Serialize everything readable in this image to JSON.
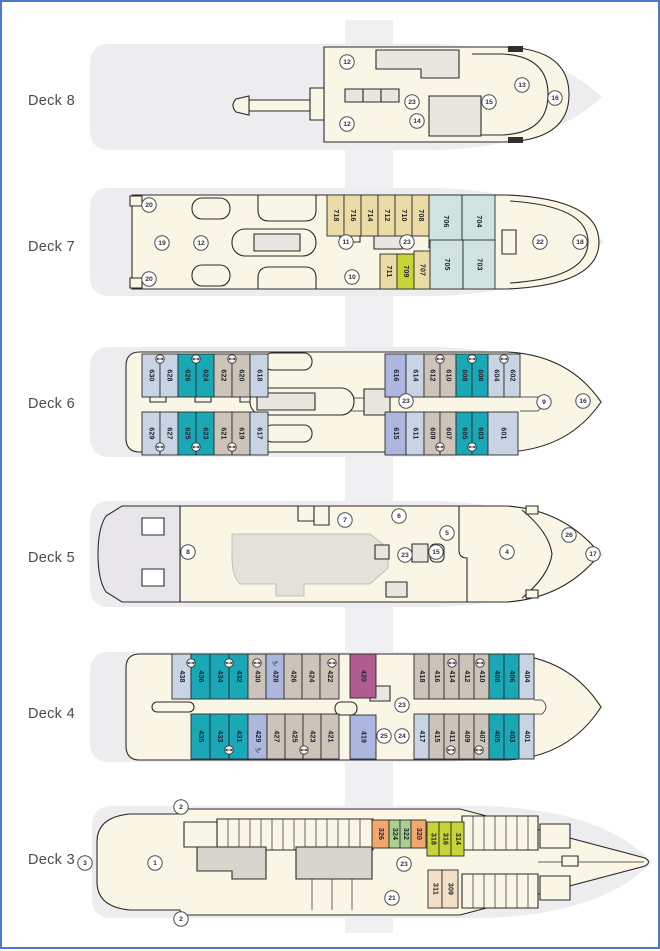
{
  "page": {
    "border_color": "#4e79cb",
    "background": "#ffffff"
  },
  "palette": {
    "cream": "#FAF6E6",
    "silhouette": "#EDEDF0",
    "room": "#E9E6E0",
    "gray3": "#D8D5CF",
    "white": "#FFFFFF",
    "lightblue": "#C8D4E3",
    "teal": "#1BA8B6",
    "graytan": "#CCC4B8",
    "periwinkle": "#ADB6DF",
    "tan": "#EBDCA6",
    "cyanpale": "#CFE3E0",
    "chartreuse": "#C6D435",
    "green": "#A9D08E",
    "orange": "#F2A76B",
    "peach": "#F3DFC5",
    "magenta": "#B05C90",
    "sterngray": "#E8E6EA",
    "outline": "#2B2B2B"
  },
  "glyphs": {
    "anchor": "⚓"
  },
  "decks": [
    {
      "id": "deck8",
      "label": "Deck 8",
      "cabins": [],
      "icons": [],
      "circles": [
        {
          "n": "12",
          "x": 345,
          "y": 60
        },
        {
          "n": "12",
          "x": 345,
          "y": 122
        },
        {
          "n": "23",
          "x": 410,
          "y": 100
        },
        {
          "n": "14",
          "x": 415,
          "y": 119
        },
        {
          "n": "15",
          "x": 487,
          "y": 100
        },
        {
          "n": "13",
          "x": 520,
          "y": 83
        },
        {
          "n": "16",
          "x": 553,
          "y": 96
        }
      ]
    },
    {
      "id": "deck7",
      "label": "Deck 7",
      "cabins": [
        {
          "num": "718",
          "x": 325,
          "y": 193,
          "w": 17,
          "h": 41,
          "color": "tan"
        },
        {
          "num": "716",
          "x": 342,
          "y": 193,
          "w": 17,
          "h": 41,
          "color": "tan"
        },
        {
          "num": "714",
          "x": 359,
          "y": 193,
          "w": 17,
          "h": 41,
          "color": "tan"
        },
        {
          "num": "712",
          "x": 376,
          "y": 193,
          "w": 17,
          "h": 41,
          "color": "tan"
        },
        {
          "num": "710",
          "x": 393,
          "y": 193,
          "w": 17,
          "h": 41,
          "color": "tan"
        },
        {
          "num": "708",
          "x": 410,
          "y": 193,
          "w": 17,
          "h": 41,
          "color": "tan"
        },
        {
          "num": "706",
          "x": 427,
          "y": 193,
          "w": 33,
          "h": 53,
          "color": "cyanpale"
        },
        {
          "num": "704",
          "x": 460,
          "y": 193,
          "w": 33,
          "h": 53,
          "color": "cyanpale"
        },
        {
          "num": "711",
          "x": 378,
          "y": 252,
          "w": 17,
          "h": 35,
          "color": "tan"
        },
        {
          "num": "709",
          "x": 395,
          "y": 252,
          "w": 17,
          "h": 35,
          "color": "chartreuse"
        },
        {
          "num": "707",
          "x": 412,
          "y": 249,
          "w": 16,
          "h": 38,
          "color": "tan"
        },
        {
          "num": "705",
          "x": 428,
          "y": 238,
          "w": 33,
          "h": 49,
          "color": "cyanpale"
        },
        {
          "num": "703",
          "x": 461,
          "y": 238,
          "w": 32,
          "h": 49,
          "color": "cyanpale"
        }
      ],
      "icons": [],
      "circles": [
        {
          "n": "20",
          "x": 147,
          "y": 203
        },
        {
          "n": "19",
          "x": 160,
          "y": 241
        },
        {
          "n": "12",
          "x": 199,
          "y": 241
        },
        {
          "n": "11",
          "x": 344,
          "y": 240
        },
        {
          "n": "23",
          "x": 405,
          "y": 240
        },
        {
          "n": "10",
          "x": 350,
          "y": 275
        },
        {
          "n": "22",
          "x": 538,
          "y": 240
        },
        {
          "n": "18",
          "x": 578,
          "y": 240
        },
        {
          "n": "20",
          "x": 147,
          "y": 277
        }
      ]
    },
    {
      "id": "deck6",
      "label": "Deck 6",
      "cabins": [
        {
          "num": "630",
          "x": 140,
          "y": 352,
          "w": 18,
          "h": 43,
          "color": "lightblue"
        },
        {
          "num": "628",
          "x": 158,
          "y": 352,
          "w": 18,
          "h": 43,
          "color": "lightblue"
        },
        {
          "num": "626",
          "x": 176,
          "y": 352,
          "w": 18,
          "h": 43,
          "color": "teal"
        },
        {
          "num": "624",
          "x": 194,
          "y": 352,
          "w": 18,
          "h": 43,
          "color": "teal"
        },
        {
          "num": "622",
          "x": 212,
          "y": 352,
          "w": 18,
          "h": 43,
          "color": "graytan"
        },
        {
          "num": "620",
          "x": 230,
          "y": 352,
          "w": 18,
          "h": 43,
          "color": "graytan"
        },
        {
          "num": "618",
          "x": 248,
          "y": 352,
          "w": 18,
          "h": 43,
          "color": "lightblue"
        },
        {
          "num": "616",
          "x": 383,
          "y": 352,
          "w": 21,
          "h": 43,
          "color": "periwinkle"
        },
        {
          "num": "614",
          "x": 404,
          "y": 352,
          "w": 18,
          "h": 43,
          "color": "lightblue"
        },
        {
          "num": "612",
          "x": 422,
          "y": 352,
          "w": 16,
          "h": 43,
          "color": "graytan"
        },
        {
          "num": "610",
          "x": 438,
          "y": 352,
          "w": 16,
          "h": 43,
          "color": "graytan"
        },
        {
          "num": "608",
          "x": 454,
          "y": 352,
          "w": 16,
          "h": 43,
          "color": "teal"
        },
        {
          "num": "606",
          "x": 470,
          "y": 352,
          "w": 16,
          "h": 43,
          "color": "teal"
        },
        {
          "num": "604",
          "x": 486,
          "y": 352,
          "w": 16,
          "h": 43,
          "color": "lightblue"
        },
        {
          "num": "602",
          "x": 502,
          "y": 352,
          "w": 16,
          "h": 43,
          "color": "lightblue"
        },
        {
          "num": "629",
          "x": 140,
          "y": 410,
          "w": 18,
          "h": 43,
          "color": "lightblue"
        },
        {
          "num": "627",
          "x": 158,
          "y": 410,
          "w": 18,
          "h": 43,
          "color": "lightblue"
        },
        {
          "num": "625",
          "x": 176,
          "y": 410,
          "w": 18,
          "h": 43,
          "color": "teal"
        },
        {
          "num": "623",
          "x": 194,
          "y": 410,
          "w": 18,
          "h": 43,
          "color": "teal"
        },
        {
          "num": "621",
          "x": 212,
          "y": 410,
          "w": 18,
          "h": 43,
          "color": "graytan"
        },
        {
          "num": "619",
          "x": 230,
          "y": 410,
          "w": 18,
          "h": 43,
          "color": "graytan"
        },
        {
          "num": "617",
          "x": 248,
          "y": 410,
          "w": 18,
          "h": 43,
          "color": "lightblue"
        },
        {
          "num": "615",
          "x": 383,
          "y": 410,
          "w": 21,
          "h": 43,
          "color": "periwinkle"
        },
        {
          "num": "611",
          "x": 404,
          "y": 410,
          "w": 18,
          "h": 43,
          "color": "lightblue"
        },
        {
          "num": "609",
          "x": 422,
          "y": 410,
          "w": 16,
          "h": 43,
          "color": "graytan"
        },
        {
          "num": "607",
          "x": 438,
          "y": 410,
          "w": 16,
          "h": 43,
          "color": "graytan"
        },
        {
          "num": "605",
          "x": 454,
          "y": 410,
          "w": 16,
          "h": 43,
          "color": "teal"
        },
        {
          "num": "603",
          "x": 470,
          "y": 410,
          "w": 16,
          "h": 43,
          "color": "teal"
        },
        {
          "num": "601",
          "x": 486,
          "y": 410,
          "w": 30,
          "h": 43,
          "color": "lightblue"
        }
      ],
      "icons": [
        {
          "t": "conn",
          "x": 158,
          "y": 357
        },
        {
          "t": "conn",
          "x": 194,
          "y": 357
        },
        {
          "t": "conn",
          "x": 230,
          "y": 357
        },
        {
          "t": "conn",
          "x": 438,
          "y": 357
        },
        {
          "t": "conn",
          "x": 470,
          "y": 357
        },
        {
          "t": "conn",
          "x": 502,
          "y": 357
        },
        {
          "t": "conn",
          "x": 158,
          "y": 445
        },
        {
          "t": "conn",
          "x": 194,
          "y": 445
        },
        {
          "t": "conn",
          "x": 230,
          "y": 445
        },
        {
          "t": "conn",
          "x": 438,
          "y": 445
        },
        {
          "t": "conn",
          "x": 470,
          "y": 445
        }
      ],
      "circles": [
        {
          "n": "23",
          "x": 404,
          "y": 399
        },
        {
          "n": "9",
          "x": 542,
          "y": 400
        },
        {
          "n": "16",
          "x": 581,
          "y": 399
        }
      ]
    },
    {
      "id": "deck5",
      "label": "Deck 5",
      "cabins": [],
      "icons": [],
      "circles": [
        {
          "n": "8",
          "x": 186,
          "y": 550
        },
        {
          "n": "7",
          "x": 343,
          "y": 518
        },
        {
          "n": "6",
          "x": 397,
          "y": 514
        },
        {
          "n": "5",
          "x": 445,
          "y": 531
        },
        {
          "n": "23",
          "x": 403,
          "y": 553
        },
        {
          "n": "15",
          "x": 434,
          "y": 550
        },
        {
          "n": "4",
          "x": 505,
          "y": 550
        },
        {
          "n": "26",
          "x": 567,
          "y": 533
        },
        {
          "n": "17",
          "x": 591,
          "y": 552
        }
      ]
    },
    {
      "id": "deck4",
      "label": "Deck 4",
      "cabins": [
        {
          "num": "438",
          "x": 170,
          "y": 652,
          "w": 19,
          "h": 45,
          "color": "lightblue"
        },
        {
          "num": "436",
          "x": 189,
          "y": 652,
          "w": 19,
          "h": 45,
          "color": "teal"
        },
        {
          "num": "434",
          "x": 208,
          "y": 652,
          "w": 19,
          "h": 45,
          "color": "teal"
        },
        {
          "num": "432",
          "x": 227,
          "y": 652,
          "w": 19,
          "h": 45,
          "color": "teal"
        },
        {
          "num": "430",
          "x": 246,
          "y": 652,
          "w": 18,
          "h": 45,
          "color": "graytan"
        },
        {
          "num": "428",
          "x": 264,
          "y": 652,
          "w": 18,
          "h": 45,
          "color": "periwinkle"
        },
        {
          "num": "426",
          "x": 282,
          "y": 652,
          "w": 18,
          "h": 45,
          "color": "graytan"
        },
        {
          "num": "424",
          "x": 300,
          "y": 652,
          "w": 18,
          "h": 45,
          "color": "graytan"
        },
        {
          "num": "422",
          "x": 318,
          "y": 652,
          "w": 19,
          "h": 45,
          "color": "graytan"
        },
        {
          "num": "420",
          "x": 348,
          "y": 652,
          "w": 26,
          "h": 44,
          "color": "magenta"
        },
        {
          "num": "418",
          "x": 412,
          "y": 652,
          "w": 15,
          "h": 45,
          "color": "graytan"
        },
        {
          "num": "416",
          "x": 427,
          "y": 652,
          "w": 15,
          "h": 45,
          "color": "graytan"
        },
        {
          "num": "414",
          "x": 442,
          "y": 652,
          "w": 15,
          "h": 45,
          "color": "graytan"
        },
        {
          "num": "412",
          "x": 457,
          "y": 652,
          "w": 15,
          "h": 45,
          "color": "graytan"
        },
        {
          "num": "410",
          "x": 472,
          "y": 652,
          "w": 15,
          "h": 45,
          "color": "graytan"
        },
        {
          "num": "408",
          "x": 487,
          "y": 652,
          "w": 15,
          "h": 45,
          "color": "teal"
        },
        {
          "num": "406",
          "x": 502,
          "y": 652,
          "w": 15,
          "h": 45,
          "color": "teal"
        },
        {
          "num": "404",
          "x": 517,
          "y": 652,
          "w": 15,
          "h": 45,
          "color": "lightblue"
        },
        {
          "num": "435",
          "x": 189,
          "y": 712,
          "w": 19,
          "h": 45,
          "color": "teal"
        },
        {
          "num": "433",
          "x": 208,
          "y": 712,
          "w": 19,
          "h": 45,
          "color": "teal"
        },
        {
          "num": "431",
          "x": 227,
          "y": 712,
          "w": 19,
          "h": 45,
          "color": "teal"
        },
        {
          "num": "429",
          "x": 246,
          "y": 712,
          "w": 19,
          "h": 45,
          "color": "periwinkle"
        },
        {
          "num": "427",
          "x": 265,
          "y": 712,
          "w": 18,
          "h": 45,
          "color": "graytan"
        },
        {
          "num": "425",
          "x": 283,
          "y": 712,
          "w": 18,
          "h": 45,
          "color": "graytan"
        },
        {
          "num": "423",
          "x": 301,
          "y": 712,
          "w": 18,
          "h": 45,
          "color": "graytan"
        },
        {
          "num": "421",
          "x": 319,
          "y": 712,
          "w": 18,
          "h": 45,
          "color": "graytan"
        },
        {
          "num": "419",
          "x": 348,
          "y": 713,
          "w": 26,
          "h": 44,
          "color": "periwinkle"
        },
        {
          "num": "417",
          "x": 412,
          "y": 712,
          "w": 15,
          "h": 45,
          "color": "lightblue"
        },
        {
          "num": "415",
          "x": 427,
          "y": 712,
          "w": 15,
          "h": 45,
          "color": "graytan"
        },
        {
          "num": "411",
          "x": 442,
          "y": 712,
          "w": 15,
          "h": 45,
          "color": "graytan"
        },
        {
          "num": "409",
          "x": 457,
          "y": 712,
          "w": 15,
          "h": 45,
          "color": "graytan"
        },
        {
          "num": "407",
          "x": 472,
          "y": 712,
          "w": 15,
          "h": 45,
          "color": "graytan"
        },
        {
          "num": "405",
          "x": 487,
          "y": 712,
          "w": 15,
          "h": 45,
          "color": "teal"
        },
        {
          "num": "403",
          "x": 502,
          "y": 712,
          "w": 15,
          "h": 45,
          "color": "teal"
        },
        {
          "num": "401",
          "x": 517,
          "y": 712,
          "w": 15,
          "h": 45,
          "color": "lightblue"
        }
      ],
      "icons": [
        {
          "t": "conn",
          "x": 189,
          "y": 661
        },
        {
          "t": "conn",
          "x": 227,
          "y": 661
        },
        {
          "t": "conn",
          "x": 255,
          "y": 661
        },
        {
          "t": "anchor",
          "x": 273,
          "y": 661
        },
        {
          "t": "conn",
          "x": 330,
          "y": 661
        },
        {
          "t": "conn",
          "x": 450,
          "y": 661
        },
        {
          "t": "conn",
          "x": 478,
          "y": 661
        },
        {
          "t": "conn",
          "x": 227,
          "y": 748
        },
        {
          "t": "anchor",
          "x": 256,
          "y": 748
        },
        {
          "t": "conn",
          "x": 302,
          "y": 748
        },
        {
          "t": "conn",
          "x": 449,
          "y": 748
        },
        {
          "t": "conn",
          "x": 477,
          "y": 748
        }
      ],
      "circles": [
        {
          "n": "23",
          "x": 400,
          "y": 703
        },
        {
          "n": "25",
          "x": 382,
          "y": 734
        },
        {
          "n": "24",
          "x": 400,
          "y": 734
        }
      ]
    },
    {
      "id": "deck3",
      "label": "Deck 3",
      "cabins": [
        {
          "num": "326",
          "x": 370,
          "y": 818,
          "w": 17,
          "h": 28,
          "color": "orange"
        },
        {
          "num": "324",
          "x": 387,
          "y": 818,
          "w": 11,
          "h": 28,
          "color": "green"
        },
        {
          "num": "322",
          "x": 398,
          "y": 818,
          "w": 11,
          "h": 28,
          "color": "green"
        },
        {
          "num": "320",
          "x": 409,
          "y": 818,
          "w": 15,
          "h": 28,
          "color": "orange"
        },
        {
          "num": "318",
          "x": 425,
          "y": 820,
          "w": 12,
          "h": 34,
          "color": "chartreuse"
        },
        {
          "num": "316",
          "x": 437,
          "y": 820,
          "w": 12,
          "h": 34,
          "color": "chartreuse"
        },
        {
          "num": "314",
          "x": 449,
          "y": 820,
          "w": 13,
          "h": 34,
          "color": "chartreuse"
        },
        {
          "num": "311",
          "x": 426,
          "y": 868,
          "w": 14,
          "h": 38,
          "color": "peach"
        },
        {
          "num": "309",
          "x": 440,
          "y": 868,
          "w": 16,
          "h": 38,
          "color": "peach"
        }
      ],
      "icons": [],
      "circles": [
        {
          "n": "3",
          "x": 83,
          "y": 861
        },
        {
          "n": "2",
          "x": 179,
          "y": 805
        },
        {
          "n": "1",
          "x": 153,
          "y": 861
        },
        {
          "n": "23",
          "x": 402,
          "y": 862
        },
        {
          "n": "21",
          "x": 390,
          "y": 896
        },
        {
          "n": "2",
          "x": 179,
          "y": 917
        }
      ]
    }
  ]
}
